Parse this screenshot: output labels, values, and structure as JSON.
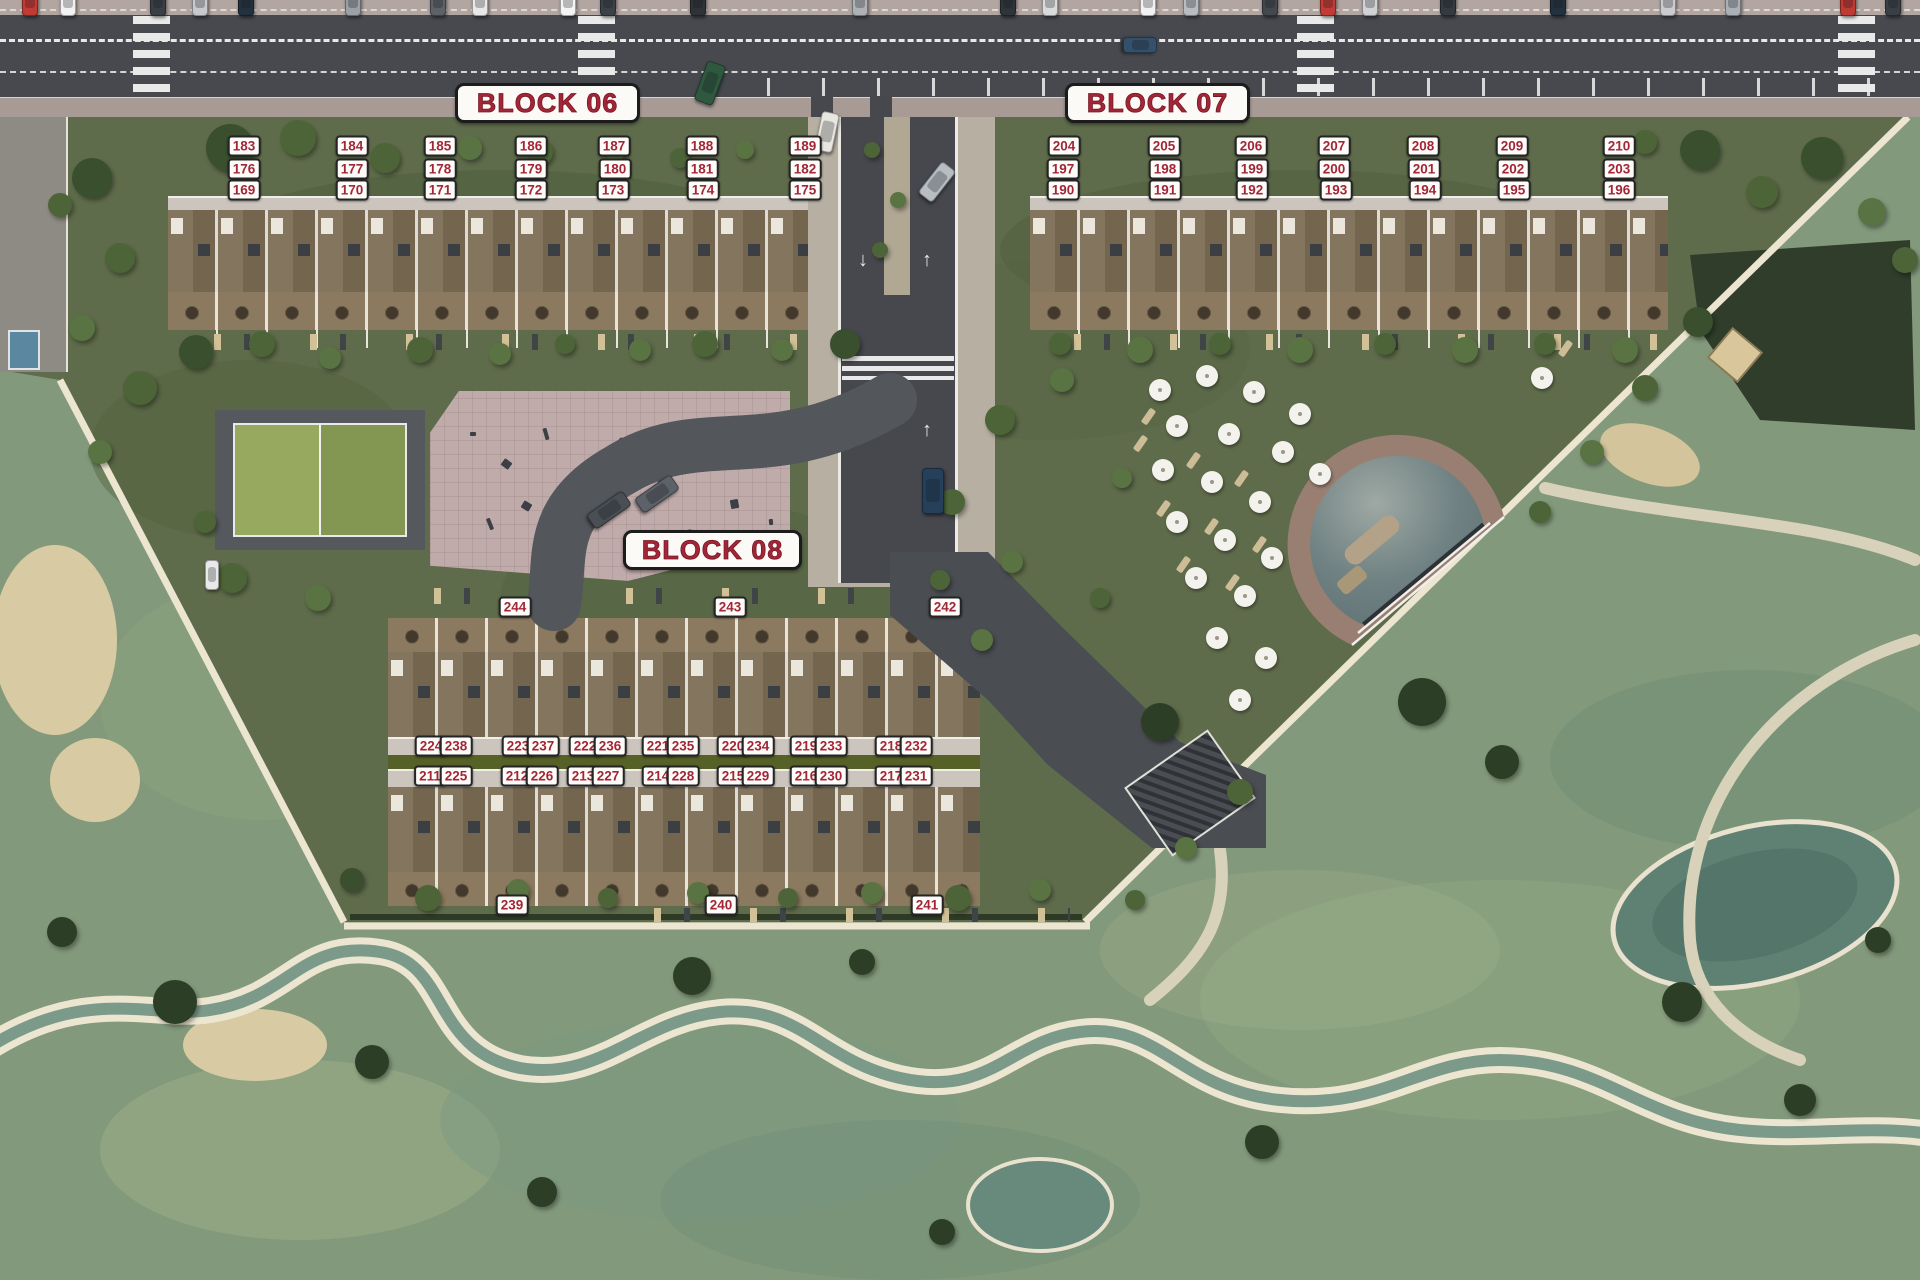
{
  "title": "Resort site plan",
  "colors": {
    "asphalt": "#47494e",
    "sidewalk-top": "#b3a6a1",
    "sidewalk-bot": "#a89b96",
    "resort-green": "#5f6c4b",
    "golf-green": "#83997b",
    "bank": "#ece5d0",
    "badge-red": "#a32638",
    "paper": "#fbfaf7",
    "wood": "#7b6b53",
    "terrace": "#8b7a5f",
    "walk": "#cbc5be"
  },
  "blocks": [
    {
      "id": "block-06",
      "label": "BLOCK 06",
      "box": {
        "x": 455,
        "y": 83,
        "w": 185,
        "h": 40
      },
      "units": [
        {
          "n": "183",
          "x": 244,
          "y": 146
        },
        {
          "n": "184",
          "x": 352,
          "y": 146
        },
        {
          "n": "185",
          "x": 440,
          "y": 146
        },
        {
          "n": "186",
          "x": 531,
          "y": 146
        },
        {
          "n": "187",
          "x": 614,
          "y": 146
        },
        {
          "n": "188",
          "x": 702,
          "y": 146
        },
        {
          "n": "189",
          "x": 805,
          "y": 146
        },
        {
          "n": "176",
          "x": 244,
          "y": 169
        },
        {
          "n": "177",
          "x": 352,
          "y": 169
        },
        {
          "n": "178",
          "x": 440,
          "y": 169
        },
        {
          "n": "179",
          "x": 531,
          "y": 169
        },
        {
          "n": "180",
          "x": 615,
          "y": 169
        },
        {
          "n": "181",
          "x": 702,
          "y": 169
        },
        {
          "n": "182",
          "x": 805,
          "y": 169
        },
        {
          "n": "169",
          "x": 244,
          "y": 190
        },
        {
          "n": "170",
          "x": 352,
          "y": 190
        },
        {
          "n": "171",
          "x": 440,
          "y": 190
        },
        {
          "n": "172",
          "x": 531,
          "y": 190
        },
        {
          "n": "173",
          "x": 613,
          "y": 190
        },
        {
          "n": "174",
          "x": 703,
          "y": 190
        },
        {
          "n": "175",
          "x": 805,
          "y": 190
        }
      ]
    },
    {
      "id": "block-07",
      "label": "BLOCK 07",
      "box": {
        "x": 1065,
        "y": 83,
        "w": 185,
        "h": 40
      },
      "units": [
        {
          "n": "204",
          "x": 1064,
          "y": 146
        },
        {
          "n": "205",
          "x": 1164,
          "y": 146
        },
        {
          "n": "206",
          "x": 1251,
          "y": 146
        },
        {
          "n": "207",
          "x": 1334,
          "y": 146
        },
        {
          "n": "208",
          "x": 1423,
          "y": 146
        },
        {
          "n": "209",
          "x": 1512,
          "y": 146
        },
        {
          "n": "210",
          "x": 1619,
          "y": 146
        },
        {
          "n": "197",
          "x": 1063,
          "y": 169
        },
        {
          "n": "198",
          "x": 1165,
          "y": 169
        },
        {
          "n": "199",
          "x": 1252,
          "y": 169
        },
        {
          "n": "200",
          "x": 1334,
          "y": 169
        },
        {
          "n": "201",
          "x": 1424,
          "y": 169
        },
        {
          "n": "202",
          "x": 1513,
          "y": 169
        },
        {
          "n": "203",
          "x": 1619,
          "y": 169
        },
        {
          "n": "190",
          "x": 1063,
          "y": 190
        },
        {
          "n": "191",
          "x": 1165,
          "y": 190
        },
        {
          "n": "192",
          "x": 1252,
          "y": 190
        },
        {
          "n": "193",
          "x": 1336,
          "y": 190
        },
        {
          "n": "194",
          "x": 1425,
          "y": 190
        },
        {
          "n": "195",
          "x": 1514,
          "y": 190
        },
        {
          "n": "196",
          "x": 1619,
          "y": 190
        }
      ]
    },
    {
      "id": "block-08",
      "label": "BLOCK 08",
      "box": {
        "x": 623,
        "y": 530,
        "w": 179,
        "h": 40
      },
      "units": [
        {
          "n": "244",
          "x": 515,
          "y": 607
        },
        {
          "n": "243",
          "x": 730,
          "y": 607
        },
        {
          "n": "242",
          "x": 945,
          "y": 607
        },
        {
          "n": "224",
          "x": 431,
          "y": 746
        },
        {
          "n": "238",
          "x": 456,
          "y": 746
        },
        {
          "n": "223",
          "x": 518,
          "y": 746
        },
        {
          "n": "237",
          "x": 543,
          "y": 746
        },
        {
          "n": "222",
          "x": 585,
          "y": 746
        },
        {
          "n": "236",
          "x": 610,
          "y": 746
        },
        {
          "n": "221",
          "x": 658,
          "y": 746
        },
        {
          "n": "235",
          "x": 683,
          "y": 746
        },
        {
          "n": "220",
          "x": 733,
          "y": 746
        },
        {
          "n": "234",
          "x": 758,
          "y": 746
        },
        {
          "n": "219",
          "x": 806,
          "y": 746
        },
        {
          "n": "233",
          "x": 831,
          "y": 746
        },
        {
          "n": "218",
          "x": 891,
          "y": 746
        },
        {
          "n": "232",
          "x": 916,
          "y": 746
        },
        {
          "n": "211",
          "x": 430,
          "y": 776
        },
        {
          "n": "225",
          "x": 456,
          "y": 776
        },
        {
          "n": "212",
          "x": 517,
          "y": 776
        },
        {
          "n": "226",
          "x": 542,
          "y": 776
        },
        {
          "n": "213",
          "x": 583,
          "y": 776
        },
        {
          "n": "227",
          "x": 608,
          "y": 776
        },
        {
          "n": "214",
          "x": 658,
          "y": 776
        },
        {
          "n": "228",
          "x": 683,
          "y": 776
        },
        {
          "n": "215",
          "x": 733,
          "y": 776
        },
        {
          "n": "229",
          "x": 758,
          "y": 776
        },
        {
          "n": "216",
          "x": 806,
          "y": 776
        },
        {
          "n": "230",
          "x": 831,
          "y": 776
        },
        {
          "n": "217",
          "x": 891,
          "y": 776
        },
        {
          "n": "231",
          "x": 916,
          "y": 776
        },
        {
          "n": "239",
          "x": 512,
          "y": 905
        },
        {
          "n": "240",
          "x": 721,
          "y": 905
        },
        {
          "n": "241",
          "x": 927,
          "y": 905
        }
      ]
    }
  ],
  "road": {
    "arrow_up": "↑",
    "arrow_down": "↓"
  },
  "trees": [
    [
      230,
      148,
      24,
      0
    ],
    [
      298,
      138,
      18,
      1
    ],
    [
      385,
      158,
      15,
      1
    ],
    [
      470,
      148,
      12,
      2
    ],
    [
      540,
      152,
      13,
      1
    ],
    [
      615,
      150,
      11,
      2
    ],
    [
      680,
      158,
      10,
      1
    ],
    [
      745,
      150,
      9,
      2
    ],
    [
      92,
      178,
      20,
      0
    ],
    [
      120,
      258,
      15,
      1
    ],
    [
      82,
      328,
      13,
      2
    ],
    [
      140,
      388,
      17,
      1
    ],
    [
      100,
      452,
      12,
      2
    ],
    [
      60,
      205,
      12,
      1
    ],
    [
      196,
      352,
      17,
      0
    ],
    [
      262,
      344,
      13,
      1
    ],
    [
      330,
      358,
      11,
      2
    ],
    [
      420,
      350,
      13,
      1
    ],
    [
      500,
      354,
      11,
      2
    ],
    [
      565,
      344,
      10,
      1
    ],
    [
      640,
      350,
      11,
      2
    ],
    [
      705,
      344,
      13,
      1
    ],
    [
      782,
      350,
      11,
      2
    ],
    [
      845,
      344,
      15,
      0
    ],
    [
      872,
      150,
      8,
      1
    ],
    [
      898,
      200,
      8,
      2
    ],
    [
      880,
      250,
      8,
      1
    ],
    [
      1060,
      344,
      11,
      1
    ],
    [
      1140,
      350,
      13,
      2
    ],
    [
      1220,
      344,
      11,
      1
    ],
    [
      1300,
      350,
      13,
      2
    ],
    [
      1385,
      344,
      11,
      1
    ],
    [
      1465,
      350,
      13,
      2
    ],
    [
      1545,
      344,
      11,
      1
    ],
    [
      1625,
      350,
      13,
      2
    ],
    [
      1700,
      150,
      20,
      0
    ],
    [
      1762,
      192,
      16,
      1
    ],
    [
      1822,
      158,
      21,
      0
    ],
    [
      1872,
      212,
      14,
      2
    ],
    [
      1645,
      142,
      12,
      1
    ],
    [
      1905,
      260,
      13,
      1
    ],
    [
      1000,
      420,
      15,
      1
    ],
    [
      1062,
      380,
      12,
      2
    ],
    [
      952,
      502,
      13,
      1
    ],
    [
      1012,
      562,
      11,
      2
    ],
    [
      1100,
      598,
      10,
      1
    ],
    [
      982,
      640,
      11,
      2
    ],
    [
      1122,
      478,
      10,
      2
    ],
    [
      940,
      580,
      10,
      1
    ],
    [
      1698,
      322,
      15,
      0
    ],
    [
      1645,
      388,
      13,
      1
    ],
    [
      1592,
      452,
      12,
      2
    ],
    [
      1540,
      512,
      11,
      1
    ],
    [
      1240,
      792,
      13,
      1
    ],
    [
      1186,
      848,
      11,
      2
    ],
    [
      1135,
      900,
      10,
      1
    ],
    [
      428,
      898,
      13,
      1
    ],
    [
      518,
      890,
      11,
      2
    ],
    [
      608,
      898,
      10,
      1
    ],
    [
      698,
      893,
      11,
      2
    ],
    [
      788,
      898,
      10,
      1
    ],
    [
      872,
      893,
      11,
      2
    ],
    [
      958,
      898,
      13,
      1
    ],
    [
      1040,
      890,
      11,
      2
    ],
    [
      352,
      880,
      12,
      0
    ],
    [
      232,
      578,
      15,
      1
    ],
    [
      318,
      598,
      13,
      2
    ],
    [
      205,
      522,
      11,
      1
    ],
    [
      175,
      1002,
      22,
      3
    ],
    [
      372,
      1062,
      17,
      3
    ],
    [
      692,
      976,
      19,
      3
    ],
    [
      862,
      962,
      13,
      3
    ],
    [
      1160,
      722,
      19,
      3
    ],
    [
      1422,
      702,
      24,
      3
    ],
    [
      1502,
      762,
      17,
      3
    ],
    [
      1682,
      1002,
      20,
      3
    ],
    [
      1262,
      1142,
      17,
      3
    ],
    [
      542,
      1192,
      15,
      3
    ],
    [
      942,
      1232,
      13,
      3
    ],
    [
      62,
      932,
      15,
      3
    ],
    [
      1800,
      1100,
      16,
      3
    ],
    [
      1878,
      940,
      13,
      3
    ]
  ],
  "tree_shades": [
    "#394f2d",
    "#4c6437",
    "#5a7342",
    "#2c3f26"
  ],
  "umbrellas": [
    [
      1160,
      390
    ],
    [
      1207,
      376
    ],
    [
      1254,
      392
    ],
    [
      1300,
      414
    ],
    [
      1177,
      426
    ],
    [
      1229,
      434
    ],
    [
      1283,
      452
    ],
    [
      1320,
      474
    ],
    [
      1163,
      470
    ],
    [
      1212,
      482
    ],
    [
      1260,
      502
    ],
    [
      1177,
      522
    ],
    [
      1225,
      540
    ],
    [
      1272,
      558
    ],
    [
      1196,
      578
    ],
    [
      1245,
      596
    ],
    [
      1217,
      638
    ],
    [
      1266,
      658
    ],
    [
      1542,
      378
    ],
    [
      1240,
      700
    ]
  ],
  "sunloungers": [
    [
      1145,
      408
    ],
    [
      1190,
      452
    ],
    [
      1238,
      470
    ],
    [
      1160,
      500
    ],
    [
      1208,
      518
    ],
    [
      1256,
      536
    ],
    [
      1180,
      556
    ],
    [
      1229,
      574
    ],
    [
      1137,
      435
    ],
    [
      1562,
      340
    ]
  ],
  "cars_parked": [
    [
      22,
      "#c13a33"
    ],
    [
      60,
      "#f2f2f2"
    ],
    [
      150,
      "#3a3f46"
    ],
    [
      192,
      "#c7c9cc"
    ],
    [
      238,
      "#23313f"
    ],
    [
      345,
      "#9aa0a6"
    ],
    [
      430,
      "#5d6268"
    ],
    [
      472,
      "#e8e8e8"
    ],
    [
      560,
      "#f4f4f4"
    ],
    [
      600,
      "#3c4148"
    ],
    [
      690,
      "#2e3338"
    ],
    [
      852,
      "#aeb2b6"
    ],
    [
      1000,
      "#2f343a"
    ],
    [
      1042,
      "#d8dadc"
    ],
    [
      1140,
      "#f1f1f1"
    ],
    [
      1183,
      "#b9bcc0"
    ],
    [
      1262,
      "#43484e"
    ],
    [
      1320,
      "#c23b35"
    ],
    [
      1362,
      "#d0d2d4"
    ],
    [
      1440,
      "#343a41"
    ],
    [
      1550,
      "#23313f"
    ],
    [
      1660,
      "#c9cbce"
    ],
    [
      1725,
      "#aab0b5"
    ],
    [
      1840,
      "#c03a34"
    ],
    [
      1885,
      "#3a3f46"
    ]
  ],
  "cars_moving": [
    [
      700,
      62,
      20,
      "#2f5840",
      20,
      42
    ],
    [
      818,
      112,
      12,
      "#e8e6e0",
      18,
      40
    ],
    [
      928,
      162,
      38,
      "#b7bdc2",
      18,
      40
    ],
    [
      922,
      468,
      0,
      "#26405c",
      22,
      46
    ],
    [
      600,
      488,
      55,
      "#4a4f55",
      18,
      44
    ],
    [
      648,
      472,
      55,
      "#5d6268",
      18,
      44
    ],
    [
      1132,
      28,
      90,
      "#35506b",
      16,
      34
    ],
    [
      205,
      560,
      0,
      "#e9e9e9",
      14,
      30
    ]
  ],
  "plaza_marks": [
    [
      470,
      432
    ],
    [
      502,
      460
    ],
    [
      540,
      432
    ],
    [
      578,
      468
    ],
    [
      618,
      440
    ],
    [
      658,
      478
    ],
    [
      698,
      450
    ],
    [
      730,
      500
    ],
    [
      592,
      520
    ],
    [
      640,
      542
    ],
    [
      688,
      530
    ],
    [
      738,
      546
    ],
    [
      768,
      520
    ],
    [
      522,
      502
    ],
    [
      484,
      522
    ],
    [
      556,
      555
    ],
    [
      610,
      500
    ]
  ]
}
